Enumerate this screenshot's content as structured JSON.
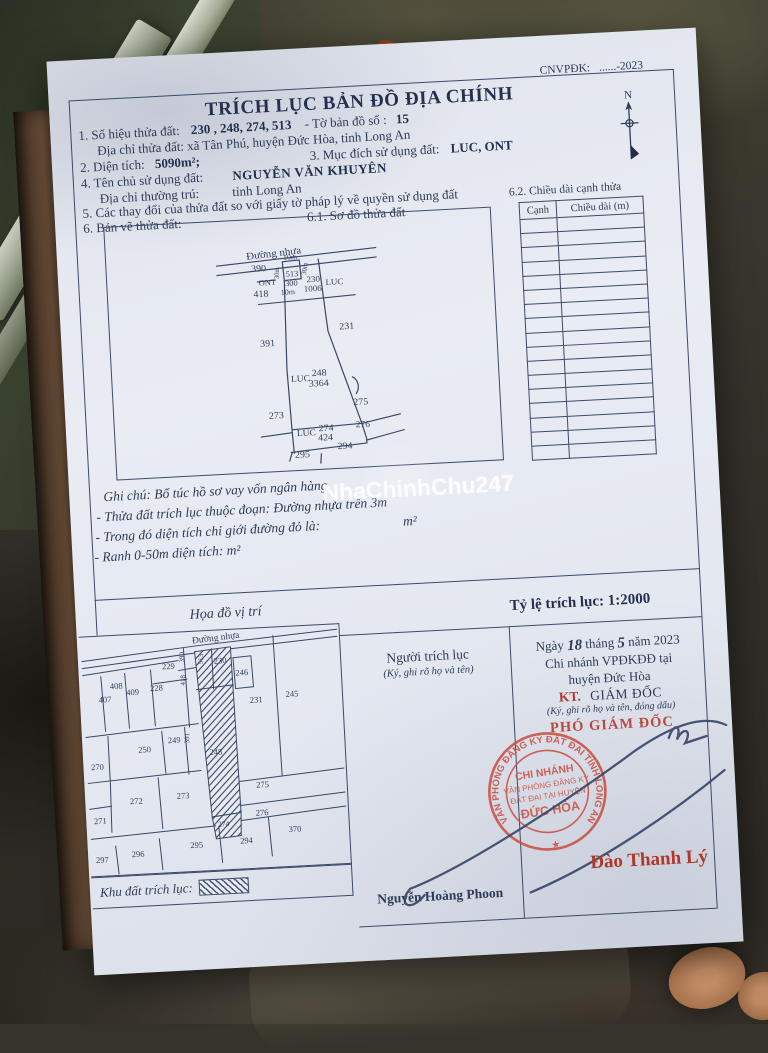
{
  "colors": {
    "paper": "#e7eaf1",
    "ink": "#2e3a57",
    "red": "#b23a2c",
    "stamp_red": "#cb5044"
  },
  "watermark": "NhaChinhChu247",
  "header": {
    "title": "TRÍCH LỤC BẢN ĐỒ ĐỊA CHÍNH",
    "code_label": "CNVPĐK:",
    "code_value": "......-2023",
    "compass_label": "N"
  },
  "info": {
    "l1a": "1. Số hiệu thửa đất:",
    "l1b": "230 , 248, 274, 513",
    "l1c": "-  Tờ bản đồ số :",
    "l1d": "15",
    "l2": "Địa chỉ thửa đất: xã Tân Phú, huyện Đức Hòa, tỉnh Long An",
    "l3a": "2. Diện tích:",
    "l3b": "5090m²;",
    "l3c": "3. Mục đích sử dụng đất:",
    "l3d": "LUC, ONT",
    "l4a": "4. Tên chủ sử dụng đất:",
    "l4b": "NGUYỄN VĂN KHUYÊN",
    "l5a": "Địa chỉ thường trú:",
    "l5b": "tỉnh Long An",
    "l6": "5. Các thay đổi của thửa đất so với giấy tờ pháp lý về quyền sử dụng đất",
    "l7a": "6. Bản vẽ thửa đất:",
    "l7b": "6.1. Sơ đồ thửa đất"
  },
  "side_table": {
    "title": "6.2. Chiều dài cạnh thửa",
    "col1": "Cạnh",
    "col2": "Chiều dài (m)",
    "empty_rows": 17
  },
  "notes": {
    "n0": "Ghi chú: Bổ túc hồ sơ vay vốn ngân hàng",
    "n1": "- Thửa đất trích lục thuộc đoạn: Đường nhựa trên 3m",
    "n2a": "- Trong đó diện tích chỉ giới đường đỏ là:",
    "n2b": "m²",
    "n3": "- Ranh 0-50m diện tích: m²"
  },
  "scale_row": {
    "map_title": "Họa đồ vị trí",
    "scale_label": "Tỷ lệ trích lục:  1:2000"
  },
  "sketch_map": {
    "labels": [
      {
        "t": "Đường nhựa",
        "x": 168,
        "y": 40,
        "r": -4,
        "s": 11
      },
      {
        "t": "390",
        "x": 152,
        "y": 55,
        "s": 10
      },
      {
        "t": "10m",
        "x": 184,
        "y": 44,
        "s": 8
      },
      {
        "t": "30m",
        "x": 172,
        "y": 58,
        "r": -85,
        "s": 7
      },
      {
        "t": "30m",
        "x": 200,
        "y": 55,
        "r": -80,
        "s": 7
      },
      {
        "t": "513",
        "x": 185,
        "y": 62,
        "s": 8.5
      },
      {
        "t": "ONT",
        "x": 160,
        "y": 70,
        "s": 8.5
      },
      {
        "t": "300",
        "x": 184,
        "y": 72,
        "s": 8.5
      },
      {
        "t": "230",
        "x": 206,
        "y": 69,
        "s": 9
      },
      {
        "t": "1006",
        "x": 205,
        "y": 79,
        "s": 9
      },
      {
        "t": "LUC",
        "x": 227,
        "y": 73,
        "s": 9
      },
      {
        "t": "418",
        "x": 153,
        "y": 82,
        "s": 10
      },
      {
        "t": "10m",
        "x": 180,
        "y": 81,
        "s": 8
      },
      {
        "t": "231",
        "x": 237,
        "y": 121,
        "s": 10
      },
      {
        "t": "391",
        "x": 157,
        "y": 135,
        "s": 10
      },
      {
        "t": "LUC",
        "x": 188,
        "y": 174,
        "s": 9.5
      },
      {
        "t": "248",
        "x": 207,
        "y": 169,
        "s": 10
      },
      {
        "t": "3364",
        "x": 206,
        "y": 180,
        "s": 10
      },
      {
        "t": "273",
        "x": 162,
        "y": 212,
        "s": 10
      },
      {
        "t": "275",
        "x": 247,
        "y": 202,
        "s": 10
      },
      {
        "t": "LUC",
        "x": 191,
        "y": 232,
        "s": 9.5
      },
      {
        "t": "274",
        "x": 211,
        "y": 228,
        "s": 10
      },
      {
        "t": "424",
        "x": 210,
        "y": 238,
        "s": 10
      },
      {
        "t": "276",
        "x": 248,
        "y": 226,
        "s": 9.5
      },
      {
        "t": "295",
        "x": 186,
        "y": 255,
        "s": 10
      },
      {
        "t": "294",
        "x": 229,
        "y": 248,
        "s": 10
      }
    ]
  },
  "location_map": {
    "labels": [
      {
        "t": "Đường nhựa",
        "x": 137,
        "y": 10,
        "r": -4,
        "s": 9.5
      },
      {
        "t": "229",
        "x": 88,
        "y": 36,
        "s": 8.5
      },
      {
        "t": "390",
        "x": 104,
        "y": 25,
        "r": -88,
        "s": 7
      },
      {
        "t": "418",
        "x": 104,
        "y": 48,
        "r": -88,
        "s": 7
      },
      {
        "t": "513",
        "x": 123,
        "y": 28,
        "r": -85,
        "s": 7
      },
      {
        "t": "230",
        "x": 140,
        "y": 33,
        "s": 8.5
      },
      {
        "t": "246",
        "x": 161,
        "y": 46,
        "s": 8.5
      },
      {
        "t": "407",
        "x": 23,
        "y": 66,
        "s": 8.5
      },
      {
        "t": "408",
        "x": 35,
        "y": 53,
        "s": 8.5
      },
      {
        "t": "409",
        "x": 51,
        "y": 60,
        "s": 8.5
      },
      {
        "t": "228",
        "x": 75,
        "y": 57,
        "s": 8.5
      },
      {
        "t": "231",
        "x": 174,
        "y": 74,
        "s": 8.5
      },
      {
        "t": "245",
        "x": 210,
        "y": 70,
        "s": 8.5
      },
      {
        "t": "249",
        "x": 90,
        "y": 110,
        "s": 8.5
      },
      {
        "t": "391",
        "x": 105,
        "y": 106,
        "r": -88,
        "s": 7
      },
      {
        "t": "250",
        "x": 60,
        "y": 118,
        "s": 8.5
      },
      {
        "t": "270",
        "x": 12,
        "y": 133,
        "s": 8.5
      },
      {
        "t": "248",
        "x": 131,
        "y": 124,
        "s": 8.5
      },
      {
        "t": "272",
        "x": 49,
        "y": 169,
        "s": 8.5
      },
      {
        "t": "273",
        "x": 96,
        "y": 166,
        "s": 8.5
      },
      {
        "t": "271",
        "x": 12,
        "y": 187,
        "s": 8.5
      },
      {
        "t": "275",
        "x": 176,
        "y": 159,
        "s": 8.5
      },
      {
        "t": "276",
        "x": 174,
        "y": 187,
        "s": 8.5
      },
      {
        "t": "274",
        "x": 135,
        "y": 196,
        "s": 7.5
      },
      {
        "t": "370",
        "x": 206,
        "y": 205,
        "s": 8.5
      },
      {
        "t": "294",
        "x": 157,
        "y": 214,
        "s": 8.5
      },
      {
        "t": "295",
        "x": 107,
        "y": 216,
        "s": 8.5
      },
      {
        "t": "296",
        "x": 48,
        "y": 222,
        "s": 8.5
      },
      {
        "t": "297",
        "x": 12,
        "y": 226,
        "s": 8.5
      }
    ],
    "legend_label": "Khu đất trích lục:"
  },
  "footer": {
    "extractor_title": "Người trích lục",
    "extractor_note": "(Ký, ghi rõ họ và tên)",
    "extractor_name": "Nguyễn Hoàng Phoon",
    "date": {
      "w1": "Ngày",
      "day": "18",
      "w2": "tháng",
      "month": "5",
      "w3": "năm 2023"
    },
    "branch1": "Chi nhánh VPĐKĐĐ tại",
    "branch2": "huyện Đức Hòa",
    "kt": "KT.",
    "director": "GIÁM ĐỐC",
    "sign_note": "(Ký, ghi rõ họ và tên, đóng dấu)",
    "deputy": "PHÓ GIÁM ĐỐC",
    "signer_name": "Đào Thanh Lý",
    "stamp": {
      "line1": "CHI NHÁNH",
      "line2": "VĂN PHÒNG ĐĂNG KÝ",
      "line3": "ĐẤT ĐAI TẠI HUYỆN",
      "line4": "ĐỨC HÒA",
      "ring": "VĂN PHÒNG ĐĂNG KÝ ĐẤT ĐAI TỈNH LONG AN",
      "star": "★"
    }
  }
}
